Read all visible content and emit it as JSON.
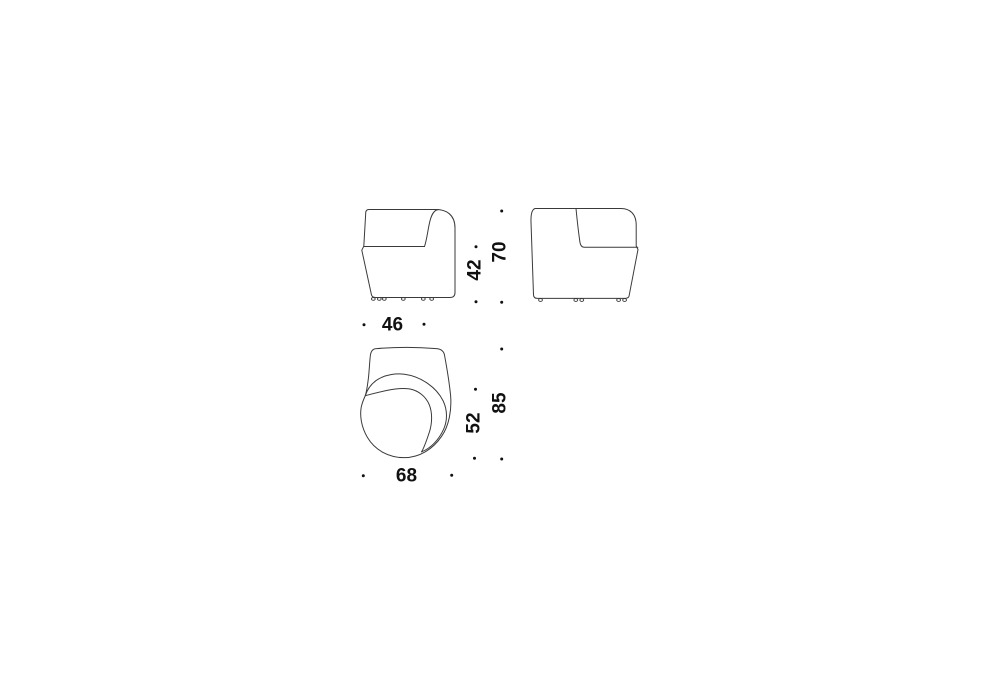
{
  "palette": {
    "background": "#ffffff",
    "line_color": "#3a3a3a",
    "text_color": "#111111",
    "dot_color": "#111111"
  },
  "dimensions": {
    "front_view": {
      "width": "46",
      "seat_height": "42",
      "overall_height": "70"
    },
    "top_view": {
      "width": "68",
      "seat_depth": "52",
      "overall_depth": "85"
    }
  }
}
